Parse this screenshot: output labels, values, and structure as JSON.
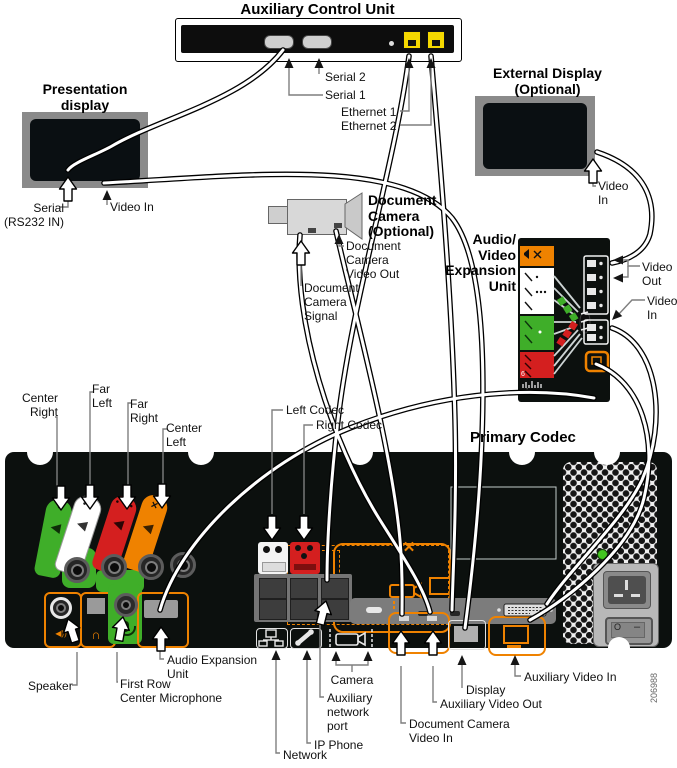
{
  "figure_number": "206988",
  "acu": {
    "title": "Auxiliary Control Unit",
    "serial2": "Serial 2",
    "serial1": "Serial 1",
    "ethernet1": "Ethernet 1",
    "ethernet2": "Ethernet 2"
  },
  "presentation": {
    "title": "Presentation\ndisplay",
    "serial": "Serial\n(RS232 IN)",
    "video_in": "Video In"
  },
  "external": {
    "title": "External Display\n(Optional)",
    "video_in": "Video\nIn"
  },
  "doccam": {
    "title": "Document\nCamera\n(Optional)",
    "video_out": "Document\nCamera\nVideo Out",
    "signal": "Document\nCamera\nSignal"
  },
  "aveu": {
    "title": "Audio/\nVideo\nExpansion\nUnit",
    "video_out": "Video\nOut",
    "video_in": "Video\nIn",
    "port_six": "6",
    "brand": "cisco"
  },
  "codec": {
    "title": "Primary Codec",
    "center_right": "Center\nRight",
    "far_left": "Far\nLeft",
    "far_right": "Far\nRight",
    "center_left": "Center\nLeft",
    "left_codec": "Left Codec",
    "right_codec": "Right Codec",
    "speaker": "Speaker",
    "first_row": "First Row\nCenter Microphone",
    "audio_expansion": "Audio Expansion\nUnit",
    "network": "Network",
    "ip_phone": "IP Phone",
    "aux_network": "Auxiliary\nnetwork\nport",
    "camera": "Camera",
    "doccam_video_in": "Document Camera\nVideo In",
    "aux_video_out": "Auxiliary Video Out",
    "display": "Display",
    "aux_video_in": "Auxiliary Video In",
    "x_mark": "✕",
    "switch_off": "O",
    "switch_on": "–",
    "tags": {
      "t1": "●",
      "t2": "● ●",
      "t3": "● ● ●",
      "t4": "✕"
    },
    "icons": {
      "speaker_cone": "◀",
      "speaker_out": "◀))",
      "headphone": "∩",
      "transfer": "↔"
    }
  },
  "colors": {
    "accent_orange": "#ef8200",
    "mic_green": "#3fae29",
    "mic_red": "#d41f1f",
    "ethernet_yellow": "#f5d800",
    "panel_black": "#0c100e",
    "monitor_gray": "#8a8a8a"
  }
}
